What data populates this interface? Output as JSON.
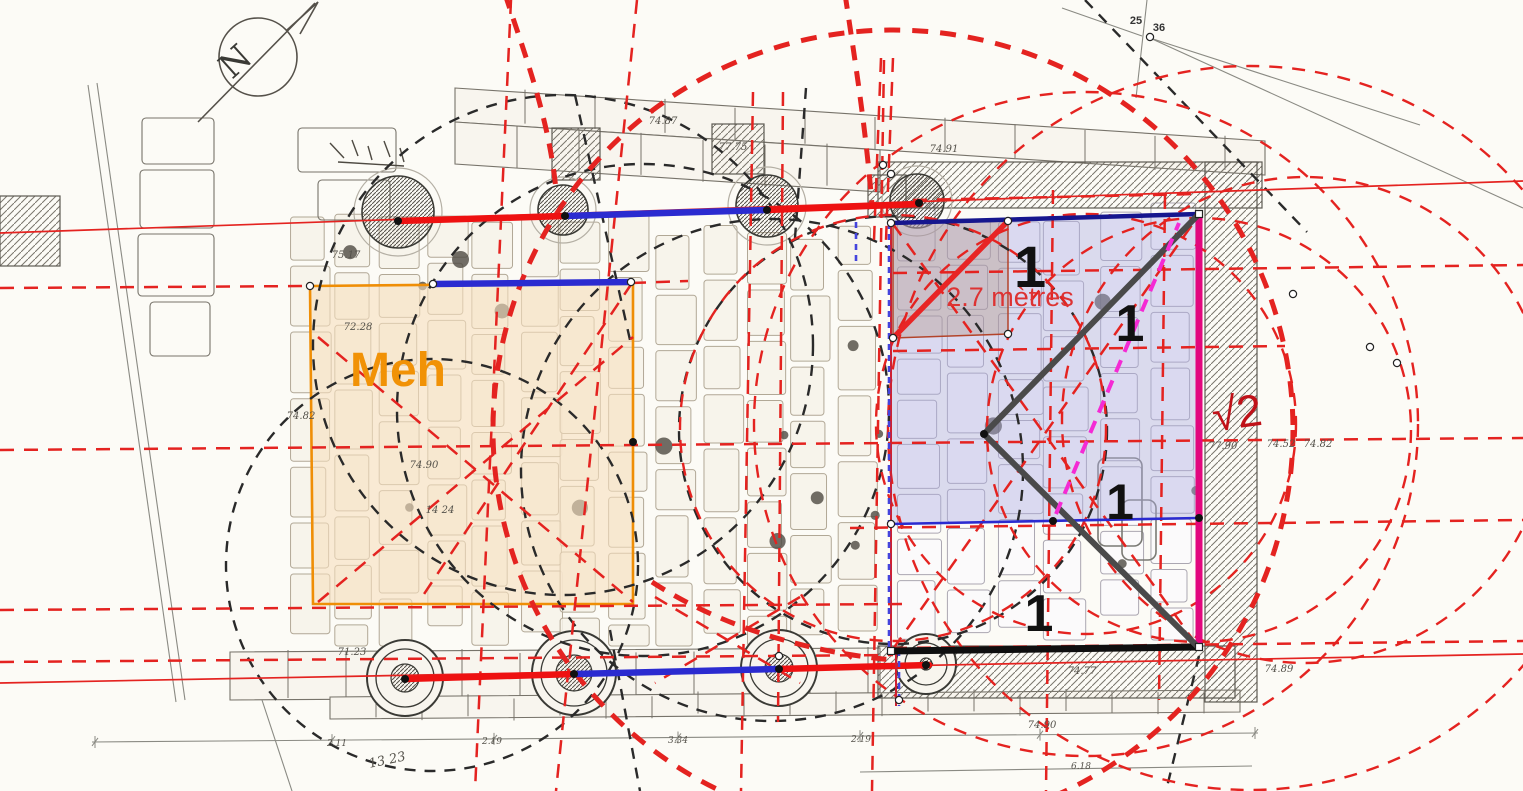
{
  "canvas": {
    "w": 1523,
    "h": 791
  },
  "colors": {
    "paper": "#fcfbf6",
    "plan_gray": "#77736a",
    "stone_fill": "#f8f5ee",
    "slab_stroke": "#a59a86",
    "red": "#e42320",
    "red_thick": "#ee1111",
    "blue": "#2b2bd0",
    "navy": "#16168e",
    "magenta_edge": "#e2077e",
    "magenta_dash": "#f42ad4",
    "charcoal": "#4a4a4a",
    "black": "#0f0f0f",
    "orange": "#ef8e06",
    "crimson": "#cf2030",
    "blue_dash": "#4444dd",
    "black_dash": "#2a2a2a",
    "meh_fill": "rgba(247,224,190,0.6)",
    "lavender_fill": "rgba(172,172,223,0.42)",
    "tan_fill": "rgba(168,132,108,0.30)"
  },
  "labels": [
    {
      "name": "meh-label",
      "text": "Meh",
      "x": 350,
      "y": 386,
      "size": 48,
      "color": "#f19206",
      "weight": "bold",
      "anchor": "start"
    },
    {
      "name": "measure-2-7-metres",
      "text": "2.7 mètres",
      "x": 1010,
      "y": 306,
      "size": 27,
      "color": "#dd3333",
      "weight": "normal",
      "anchor": "middle"
    },
    {
      "name": "sqrt2-label",
      "text": "√2",
      "x": 1239,
      "y": 428,
      "size": 45,
      "color": "#c01118",
      "weight": "normal",
      "anchor": "middle",
      "rotate": -8
    },
    {
      "name": "unit-1-top",
      "text": "1",
      "x": 1030,
      "y": 287,
      "size": 58,
      "color": "#111111",
      "weight": "bold",
      "anchor": "middle"
    },
    {
      "name": "unit-1-diagonal",
      "text": "1",
      "x": 1130,
      "y": 341,
      "size": 52,
      "color": "#111111",
      "weight": "bold",
      "anchor": "middle"
    },
    {
      "name": "unit-1-mid",
      "text": "1",
      "x": 1120,
      "y": 519,
      "size": 50,
      "color": "#111111",
      "weight": "bold",
      "anchor": "middle"
    },
    {
      "name": "unit-1-bottom",
      "text": "1",
      "x": 1039,
      "y": 631,
      "size": 52,
      "color": "#111111",
      "weight": "bold",
      "anchor": "middle"
    },
    {
      "name": "compass-n",
      "text": "N",
      "x": 243,
      "y": 70,
      "size": 34,
      "color": "#3a3a35",
      "weight": "normal",
      "anchor": "middle",
      "rotate": -42,
      "serif": true
    },
    {
      "name": "point-25",
      "text": "25",
      "x": 1136,
      "y": 24,
      "size": 11,
      "color": "#333333",
      "weight": "bold",
      "anchor": "middle"
    },
    {
      "name": "point-36",
      "text": "36",
      "x": 1159,
      "y": 31,
      "size": 11,
      "color": "#333333",
      "weight": "bold",
      "anchor": "middle"
    }
  ],
  "plan_numbers": [
    {
      "t": "74.87",
      "x": 663,
      "y": 124
    },
    {
      "t": "77.75",
      "x": 733,
      "y": 150
    },
    {
      "t": "74.91",
      "x": 944,
      "y": 152
    },
    {
      "t": "75.17",
      "x": 346,
      "y": 258
    },
    {
      "t": "72.28",
      "x": 358,
      "y": 330
    },
    {
      "t": "74.82",
      "x": 301,
      "y": 419
    },
    {
      "t": "74.90",
      "x": 424,
      "y": 468
    },
    {
      "t": "14 24",
      "x": 440,
      "y": 513
    },
    {
      "t": "71.23",
      "x": 352,
      "y": 655
    },
    {
      "t": "77.90",
      "x": 1223,
      "y": 449
    },
    {
      "t": "74.52",
      "x": 1281,
      "y": 447
    },
    {
      "t": "74.82",
      "x": 1318,
      "y": 447
    },
    {
      "t": "74.77",
      "x": 1082,
      "y": 674
    },
    {
      "t": "74.89",
      "x": 1279,
      "y": 672
    },
    {
      "t": "74.90",
      "x": 1042,
      "y": 728
    },
    {
      "t": "2.11",
      "x": 337,
      "y": 746,
      "s": 9
    },
    {
      "t": "2.19",
      "x": 492,
      "y": 744,
      "s": 9
    },
    {
      "t": "3.34",
      "x": 678,
      "y": 743,
      "s": 9
    },
    {
      "t": "2.19",
      "x": 861,
      "y": 742,
      "s": 9
    },
    {
      "t": "6.18",
      "x": 1081,
      "y": 769,
      "s": 9
    },
    {
      "t": "13  23",
      "x": 388,
      "y": 764,
      "s": 13,
      "r": -12
    }
  ],
  "overlay": {
    "thin_red_lines": [
      [
        0,
        233,
        1523,
        181
      ],
      [
        0,
        683,
        1523,
        654
      ]
    ],
    "thick_red_segments": [
      [
        398,
        221,
        565,
        216
      ],
      [
        767,
        210,
        920,
        204
      ],
      [
        405,
        679,
        574,
        674
      ],
      [
        779,
        669,
        929,
        665
      ]
    ],
    "thick_blue_segments": [
      [
        565,
        216,
        767,
        210
      ],
      [
        574,
        674,
        779,
        669
      ],
      [
        433,
        284,
        631,
        282
      ]
    ],
    "blue_thin": [
      891,
      524,
      1199,
      518
    ],
    "navy_top": [
      891,
      223,
      1199,
      214
    ],
    "magenta_edge": [
      1199,
      214,
      1199,
      647
    ],
    "black_bottom": [
      891,
      651,
      1199,
      647
    ],
    "left_edge_red": [
      891,
      223,
      891,
      651
    ],
    "left_stub_red": [
      896,
      648,
      896,
      706
    ],
    "blue_dash_segments": [
      [
        889,
        223,
        889,
        651
      ],
      [
        856,
        222,
        856,
        262
      ],
      [
        899,
        650,
        899,
        706
      ]
    ],
    "meh_square": "310,286 633,283 633,604 313,604",
    "lavender_poly": "891,223 1199,214 1199,518 891,524",
    "tan_square": "893,224 1008,221 1008,334 893,338",
    "tan_diagonal": [
      893,
      338,
      1008,
      221
    ],
    "charcoal_polyline": "1197,216 984,434 1197,646",
    "magenta_dash_line": [
      1056,
      514,
      1179,
      223
    ],
    "red_dash_lines": [
      [
        0,
        288,
        310,
        286
      ],
      [
        632,
        283,
        688,
        281
      ],
      [
        0,
        450,
        1523,
        438
      ],
      [
        0,
        610,
        905,
        604
      ],
      [
        0,
        662,
        893,
        655
      ],
      [
        893,
        648,
        1523,
        641
      ],
      [
        893,
        273,
        1523,
        265
      ],
      [
        893,
        351,
        1285,
        346
      ],
      [
        850,
        528,
        1523,
        520
      ],
      [
        913,
        200,
        1199,
        194
      ],
      [
        511,
        0,
        475,
        791
      ],
      [
        637,
        0,
        556,
        791
      ],
      [
        753,
        92,
        741,
        791
      ],
      [
        783,
        92,
        778,
        722
      ],
      [
        884,
        60,
        872,
        791
      ],
      [
        1053,
        190,
        1046,
        791
      ],
      [
        1165,
        195,
        1159,
        700
      ],
      [
        881,
        58,
        874,
        240
      ],
      [
        893,
        58,
        886,
        240
      ],
      [
        893,
        649,
        1199,
        215
      ],
      [
        893,
        224,
        1199,
        648
      ],
      [
        318,
        602,
        633,
        337
      ],
      [
        318,
        337,
        633,
        602
      ],
      [
        632,
        283,
        420,
        600
      ],
      [
        655,
        597,
        800,
        683
      ],
      [
        800,
        597,
        655,
        683
      ]
    ],
    "red_dash_circles": [
      [
        1086,
        424,
        210
      ],
      [
        1199,
        430,
        212
      ],
      [
        1305,
        420,
        243
      ],
      [
        1086,
        424,
        332
      ],
      [
        1250,
        428,
        362
      ],
      [
        893,
        428,
        213
      ]
    ],
    "red_thick_circles": [
      [
        893,
        430,
        400
      ]
    ],
    "red_thick_paths": [
      "M505,-6 C525,55 549,118 556,190",
      "M845,-6 C855,60 866,130 872,205",
      "M652,582 C720,626 805,652 893,660"
    ],
    "black_dash_circles": [
      [
        563,
        345,
        250
      ],
      [
        643,
        410,
        246
      ],
      [
        772,
        470,
        251
      ],
      [
        432,
        565,
        206
      ],
      [
        893,
        430,
        214
      ]
    ],
    "black_dash_lines": [
      [
        1085,
        0,
        1307,
        232
      ],
      [
        806,
        88,
        795,
        238
      ],
      [
        1199,
        656,
        1166,
        791
      ],
      [
        575,
        95,
        630,
        340
      ],
      [
        610,
        630,
        640,
        791
      ]
    ],
    "gray_lines": [
      [
        88,
        85,
        176,
        702
      ],
      [
        97,
        83,
        185,
        700
      ],
      [
        1150,
        38,
        1523,
        208
      ],
      [
        1150,
        38,
        1420,
        125
      ],
      [
        1062,
        8,
        1142,
        36
      ],
      [
        1147,
        0,
        1136,
        98
      ],
      [
        92,
        742,
        1258,
        733
      ],
      [
        262,
        700,
        292,
        791
      ],
      [
        860,
        772,
        1252,
        766
      ]
    ],
    "black_dots": [
      [
        398,
        221
      ],
      [
        565,
        216
      ],
      [
        767,
        210
      ],
      [
        919,
        203
      ],
      [
        405,
        679
      ],
      [
        574,
        674
      ],
      [
        779,
        669
      ],
      [
        926,
        665
      ],
      [
        1053,
        521
      ],
      [
        1199,
        518
      ],
      [
        984,
        434
      ],
      [
        633,
        442
      ]
    ],
    "white_dots": [
      [
        310,
        286
      ],
      [
        433,
        284
      ],
      [
        631,
        282
      ],
      [
        891,
        223
      ],
      [
        1008,
        221
      ],
      [
        1008,
        334
      ],
      [
        893,
        338
      ],
      [
        891,
        524
      ],
      [
        779,
        656
      ],
      [
        1150,
        37
      ],
      [
        1293,
        294
      ],
      [
        1370,
        347
      ],
      [
        1397,
        363
      ],
      [
        883,
        165
      ],
      [
        891,
        174
      ],
      [
        899,
        700
      ]
    ],
    "white_squares": [
      [
        1199,
        214
      ],
      [
        891,
        651
      ],
      [
        1199,
        647
      ]
    ]
  },
  "base": {
    "hatch_rects": [
      [
        878,
        162,
        384,
        46
      ],
      [
        1205,
        162,
        52,
        540
      ],
      [
        878,
        646,
        357,
        52
      ],
      [
        552,
        128,
        48,
        52
      ],
      [
        712,
        124,
        52,
        50
      ],
      [
        868,
        175,
        38,
        42
      ],
      [
        0,
        196,
        60,
        70
      ]
    ],
    "stone_rows": [
      [
        455,
        88,
        1265,
        141,
        34,
        70
      ],
      [
        455,
        122,
        880,
        150,
        42,
        62
      ],
      [
        230,
        652,
        880,
        648,
        48,
        58
      ],
      [
        330,
        697,
        1240,
        690,
        22,
        46
      ]
    ],
    "left_stack": [
      [
        142,
        118,
        72,
        46
      ],
      [
        140,
        170,
        74,
        58
      ],
      [
        138,
        234,
        76,
        62
      ],
      [
        150,
        302,
        60,
        54
      ],
      [
        298,
        128,
        98,
        44
      ],
      [
        318,
        180,
        72,
        40
      ]
    ],
    "columns_top": [
      [
        398,
        212,
        36
      ],
      [
        563,
        210,
        25
      ],
      [
        767,
        206,
        31
      ],
      [
        917,
        201,
        27
      ]
    ],
    "columns_bottom": [
      [
        405,
        678,
        38
      ],
      [
        574,
        673,
        42
      ],
      [
        779,
        668,
        38
      ],
      [
        926,
        664,
        30
      ]
    ],
    "slab_fields": [
      {
        "x0": 286,
        "x1": 886,
        "y0": 238,
        "y1": 648,
        "cw": 46,
        "rh": 76,
        "stroke": "#a59a86",
        "fill": "#f7f3ea",
        "pebbles": 14
      },
      {
        "x0": 895,
        "x1": 1197,
        "y0": 228,
        "y1": 642,
        "cw": 50,
        "rh": 70,
        "stroke": "#9e99a6",
        "fill": "#fbfafd",
        "pebbles": 4
      }
    ],
    "rounded_rects": [
      [
        1098,
        458,
        44,
        88
      ],
      [
        1122,
        500,
        34,
        60
      ]
    ],
    "scribbles": [
      [
        330,
        143,
        344,
        158
      ],
      [
        352,
        140,
        358,
        156
      ],
      [
        368,
        146,
        372,
        160
      ],
      [
        384,
        141,
        390,
        157
      ],
      [
        400,
        148,
        404,
        162
      ],
      [
        338,
        162,
        404,
        166
      ]
    ],
    "dim_ticks": [
      95,
      332,
      494,
      678,
      860,
      1040,
      1255
    ],
    "compass": {
      "cx": 258,
      "cy": 57,
      "r": 39
    }
  }
}
